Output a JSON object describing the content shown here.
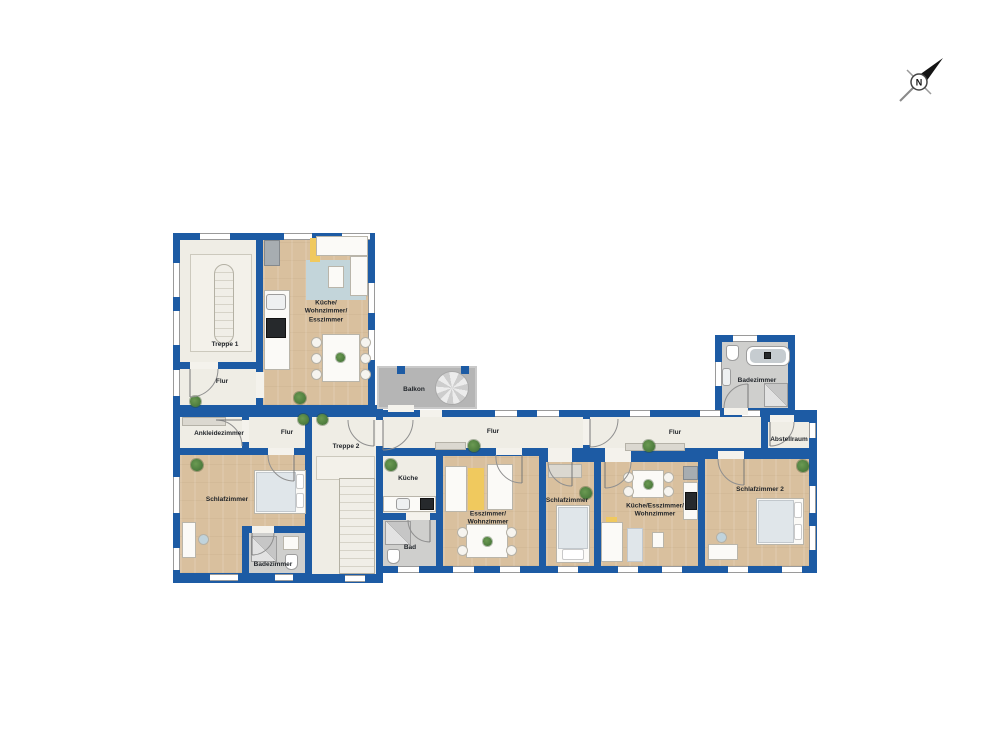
{
  "plan": {
    "rooms": {
      "treppe1": {
        "label": "Treppe 1"
      },
      "flur_upper": {
        "label": "Flur"
      },
      "kueche_wohn_ess": {
        "label": "Küche/\nWohnzimmer/\nEsszimmer"
      },
      "balkon": {
        "label": "Balkon"
      },
      "badezimmer_og": {
        "label": "Badezimmer"
      },
      "ankleidezimmer": {
        "label": "Ankleidezimmer"
      },
      "flur_mid": {
        "label": "Flur"
      },
      "treppe2": {
        "label": "Treppe 2"
      },
      "flur_corridor_left": {
        "label": "Flur"
      },
      "flur_corridor_right": {
        "label": "Flur"
      },
      "abstellraum": {
        "label": "Abstellraum"
      },
      "schlafzimmer_west": {
        "label": "Schlafzimmer"
      },
      "badezimmer_west": {
        "label": "Badezimmer"
      },
      "kueche_sued": {
        "label": "Küche"
      },
      "bad_sued": {
        "label": "Bad"
      },
      "esszimmer_wohnzimmer": {
        "label": "Esszimmer/\nWohnzimmer"
      },
      "schlafzimmer_mitte": {
        "label": "Schlafzimmer"
      },
      "kueche_ess_wohn": {
        "label": "Küche/Esszimmer/\nWohnzimmer"
      },
      "schlafzimmer2": {
        "label": "Schlafzimmer 2"
      }
    },
    "compass": {
      "north_label": "N"
    },
    "colors": {
      "wall": "#1d5ba4",
      "wood_floor": "#d9c09e",
      "light_floor": "#efede5",
      "bath_floor": "#cfcfcd",
      "balcony": "#b5b5b5",
      "rug_blue": "#c3d5da",
      "accent_yellow": "#f0c95e",
      "plant_green": "#4a7a3a"
    }
  }
}
